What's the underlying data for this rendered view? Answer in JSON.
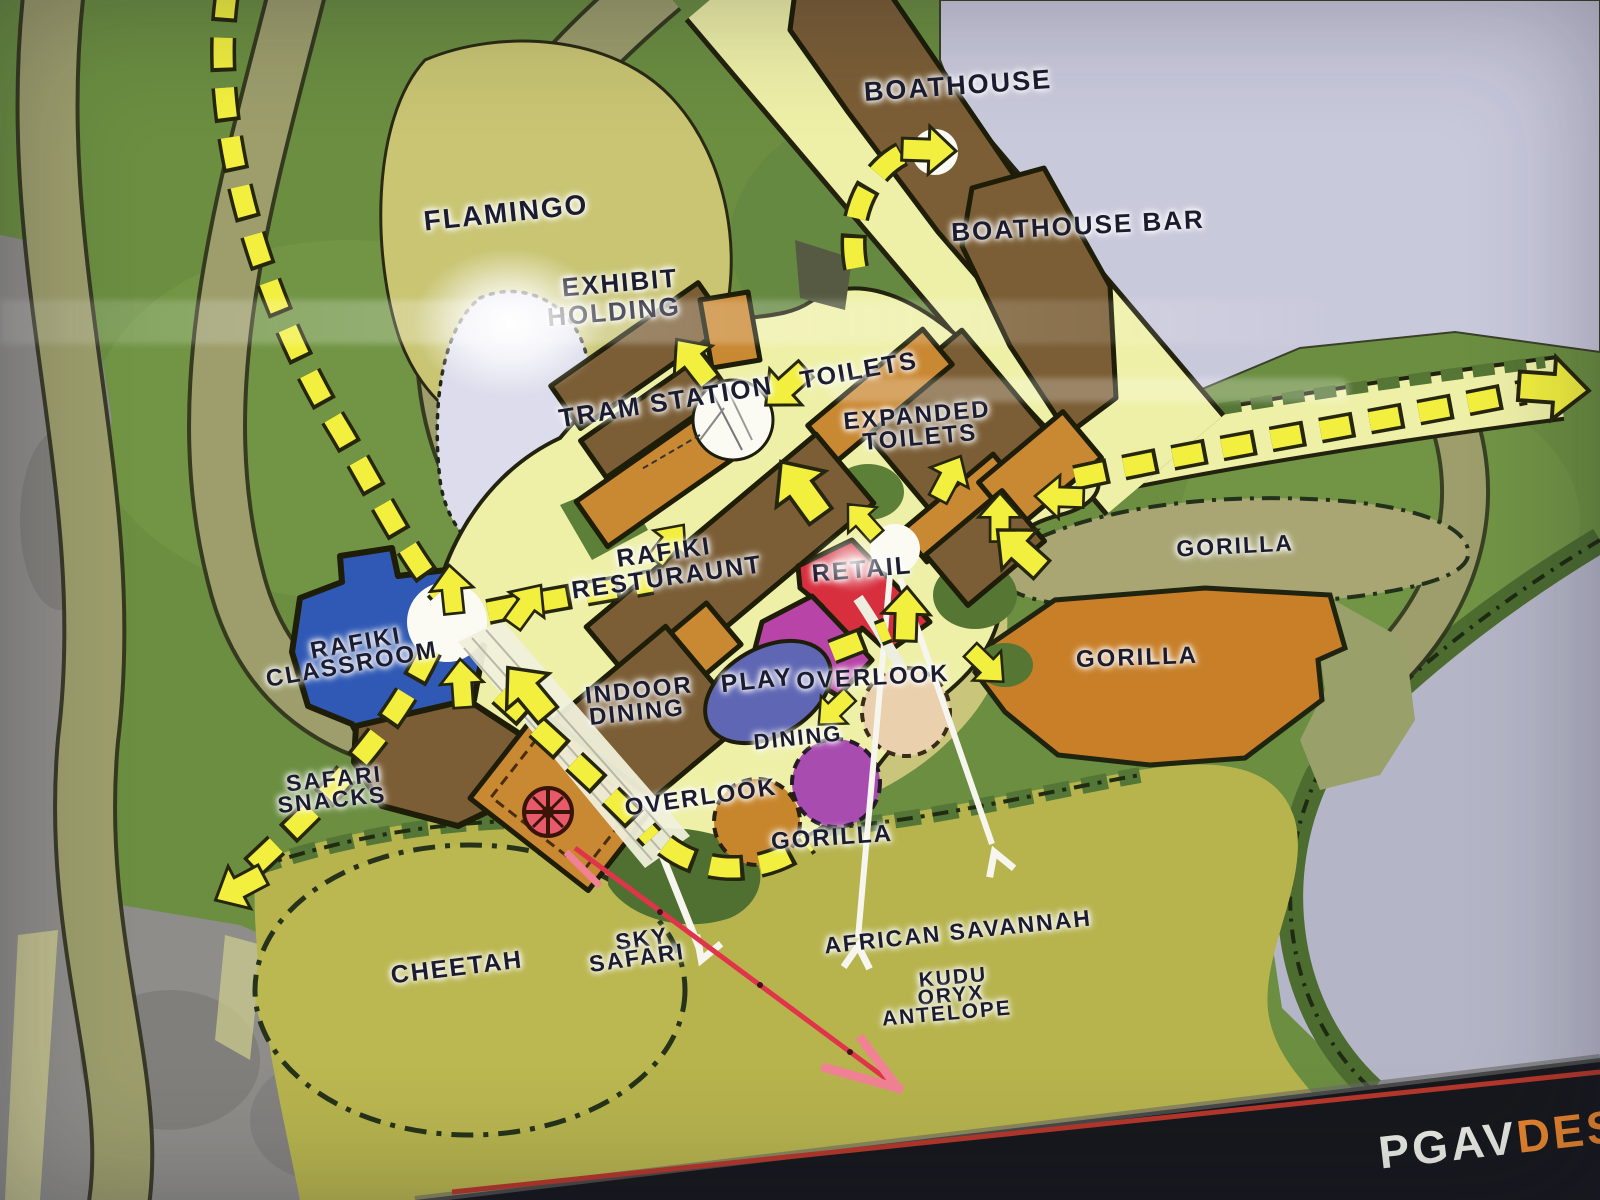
{
  "labels": {
    "boathouse": "BOATHOUSE",
    "boathouse_bar": "BOATHOUSE BAR",
    "flamingo": "FLAMINGO",
    "exhibit_holding_1": "EXHIBIT",
    "exhibit_holding_2": "HOLDING",
    "tram_station": "TRAM STATION",
    "toilets": "TOILETS",
    "expanded_toilets_1": "EXPANDED",
    "expanded_toilets_2": "TOILETS",
    "rafiki_restaurant_1": "RAFIKI",
    "rafiki_restaurant_2": "RESTURAUNT",
    "retail": "RETAIL",
    "rafiki_classroom_1": "RAFIKI",
    "rafiki_classroom_2": "CLASSROOM",
    "indoor_dining_1": "INDOOR",
    "indoor_dining_2": "DINING",
    "play": "PLAY",
    "overlook_upper": "OVERLOOK",
    "dining": "DINING",
    "overlook_lower": "OVERLOOK",
    "gorilla_center": "GORILLA",
    "safari_snacks_1": "SAFARI",
    "safari_snacks_2": "SNACKS",
    "gorilla_upper": "GORILLA",
    "gorilla_exhibit": "GORILLA",
    "cheetah": "CHEETAH",
    "sky_safari_1": "SKY",
    "sky_safari_2": "SAFARI",
    "african_savannah": "AFRICAN SAVANNAH",
    "kudu": "KUDU",
    "oryx": "ORYX",
    "antelope": "ANTELOPE"
  },
  "footer": {
    "logo_part1": "PGAV",
    "logo_part2": "DES"
  },
  "colors": {
    "grass": "#6b8e41",
    "rock": "#8e8d89",
    "water": "#c9c9dc",
    "water_far": "#b4b5c6",
    "flamingo_area": "#c9c573",
    "pond": "#dcdcec",
    "savanna": "#b7b44e",
    "road": "#9d9e6c",
    "plaza_path": "#eef0a8",
    "trail_yellow": "#f2ef3f",
    "building_brown": "#7b5e36",
    "building_orange": "#c98832",
    "retail_red": "#d82f3e",
    "retail_magenta": "#b844a8",
    "play_blue": "#5f66b4",
    "dining_purple": "#a84cb0",
    "classroom_blue": "#3059b5",
    "gorilla_orange": "#c87f28",
    "white_node": "#fbfbf4",
    "label_ink": "#1c1c30",
    "footer_bar": "#17181d",
    "footer_red": "#b5372b",
    "logo_orange": "#e8862e"
  }
}
